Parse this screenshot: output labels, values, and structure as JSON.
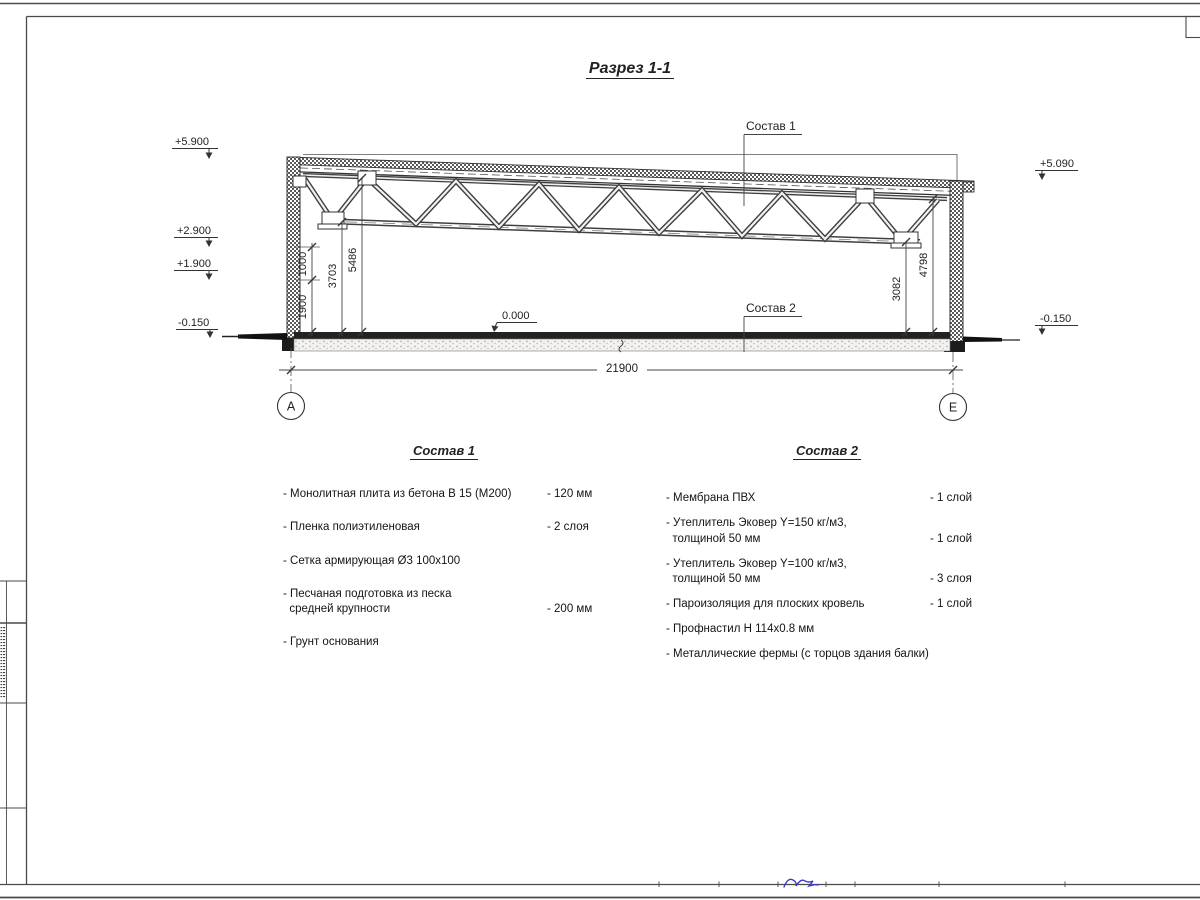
{
  "header": {
    "title": "Разрез 1-1"
  },
  "drawing": {
    "label_sostav1": "Состав 1",
    "label_sostav2": "Состав 2",
    "elevations": {
      "left_roof": "+5.900",
      "left_mid1": "+2.900",
      "left_mid2": "+1.900",
      "left_ground": "-0.150",
      "right_roof": "+5.090",
      "right_ground": "-0.150",
      "zero": "0.000"
    },
    "dimensions": {
      "v1900": "1900",
      "v1000": "1000",
      "v3703": "3703",
      "v5486": "5486",
      "v3082": "3082",
      "v4798": "4798",
      "overall": "21900"
    },
    "axes": {
      "left": "А",
      "right": "Е"
    }
  },
  "list1": {
    "heading": "Состав 1",
    "items": [
      {
        "name": "- Монолитная плита из бетона В 15 (М200)",
        "value": "- 120 мм"
      },
      {
        "name": "- Пленка полиэтиленовая",
        "value": "- 2 слоя"
      },
      {
        "name": "- Сетка армирующая Ø3 100х100",
        "value": ""
      },
      {
        "name": "- Песчаная подготовка из песка\n  средней крупности",
        "value": "- 200 мм"
      },
      {
        "name": "- Грунт основания",
        "value": ""
      }
    ]
  },
  "list2": {
    "heading": "Состав 2",
    "items": [
      {
        "name": "- Мембрана ПВХ",
        "value": "- 1 слой"
      },
      {
        "name": "- Утеплитель Эковер Y=150 кг/м3,\n  толщиной 50 мм",
        "value": "- 1 слой"
      },
      {
        "name": "- Утеплитель Эковер Y=100 кг/м3,\n  толщиной 50 мм",
        "value": "- 3 слоя"
      },
      {
        "name": "- Пароизоляция для плоских кровель",
        "value": "- 1 слой"
      },
      {
        "name": "- Профнастил Н 114х0.8 мм",
        "value": ""
      },
      {
        "name": "- Металлические фермы (с торцов здания балки)",
        "value": ""
      }
    ]
  },
  "colors": {
    "line": "#3c3c3c",
    "signature": "#3a3ac8"
  }
}
